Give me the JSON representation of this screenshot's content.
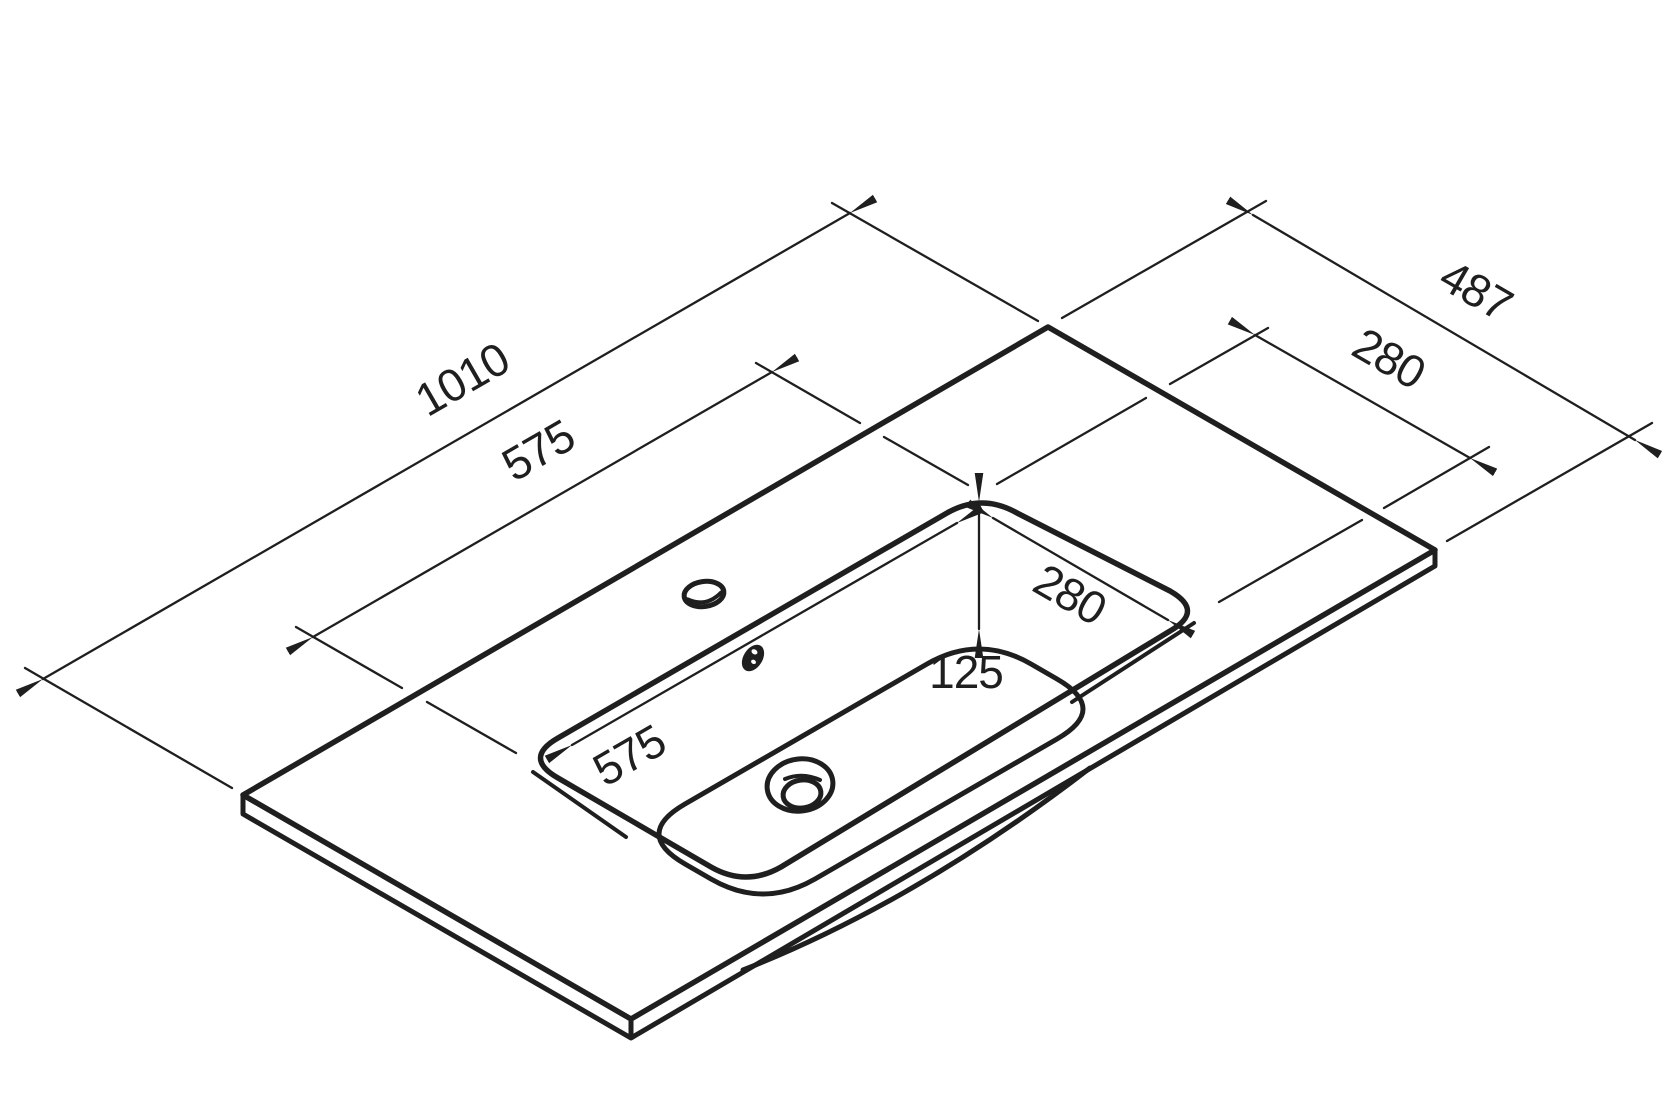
{
  "drawing": {
    "title": "Washbasin countertop isometric dimension drawing",
    "background": "#ffffff",
    "stroke_color": "#1f1f1f",
    "unit": "mm",
    "dimensions": {
      "overall_length": "1010",
      "overall_depth": "487",
      "deck_cutout_length": "575",
      "deck_cutout_depth": "280",
      "bowl_opening_length": "575",
      "bowl_opening_depth": "280",
      "bowl_inner_depth": "125"
    },
    "features": {
      "faucet_hole": "faucet-hole",
      "overflow_hole": "overflow-hole",
      "drain_hole": "drain-hole"
    }
  }
}
